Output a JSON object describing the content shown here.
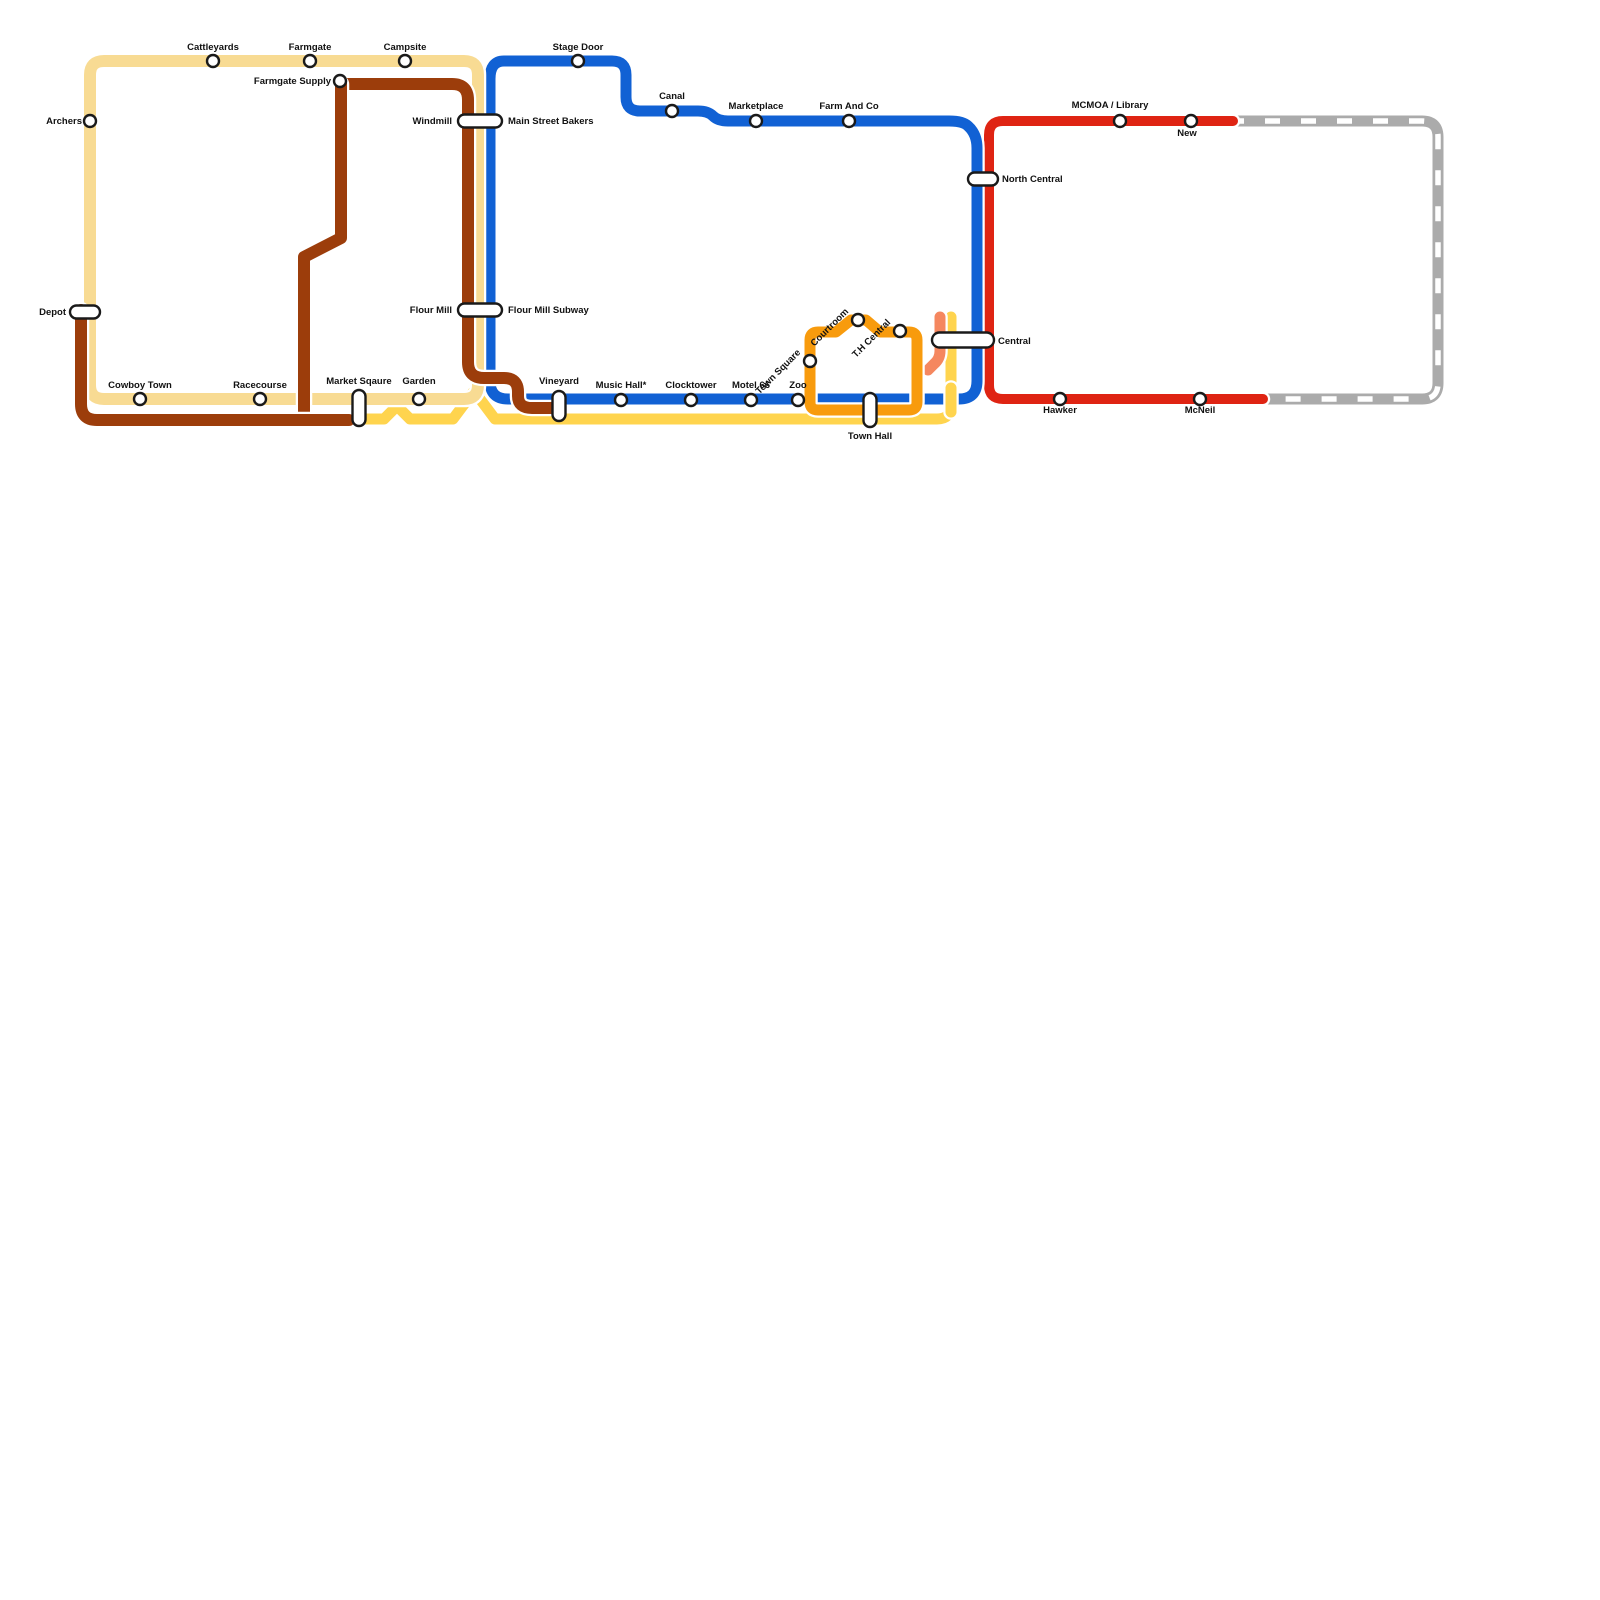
{
  "map": {
    "background": "#ffffff",
    "station_style": {
      "fill": "#ffffff",
      "stroke": "#1a1a1a",
      "stroke_width": 2.4,
      "circle_radius": 6,
      "label_size": 9.5
    },
    "lines": [
      {
        "id": "gray-planned",
        "color": "#ABABAB",
        "width": 11,
        "dash_overlay": {
          "color": "#ffffff",
          "width": 5.5,
          "dasharray": "15 21"
        },
        "d": "M 1237 121 H 1422 Q 1438 121 1438 137 V 383 Q 1438 399 1422 399 H 1264"
      },
      {
        "id": "red-line",
        "color": "#DF2413",
        "width": 10,
        "d": "M 1233 121 H 1003 Q 989 121 989 135 V 385 Q 989 399 1003 399 H 1263"
      },
      {
        "id": "yellow-line",
        "color": "#FFD44E",
        "width": 11,
        "d": "M 365 419 H 384 L 397 406 L 410 419 H 453 L 474 391 L 495 419 H 937 Q 951 419 951 405 V 317"
      },
      {
        "id": "salmon-line",
        "color": "#F5875F",
        "width": 11,
        "d": "M 940 317 V 351 Q 940 359 934 364 L 928 370"
      },
      {
        "id": "blue-line",
        "color": "#1161D4",
        "width": 11,
        "d": "M 504 61 H 612 Q 626 61 626 75 V 97 Q 626 111 640 111 H 698 Q 708 111 713 116 Q 718 121 728 121 H 949 Q 963 121 968 126 Q 977 134 977 148 V 381 Q 977 399 959 399 H 508 Q 490 399 490 381 V 79 Q 490 61 504 61 Z"
      },
      {
        "id": "cream-line",
        "color": "#F8DB93",
        "width": 12,
        "d": "M 104 61 H 464 Q 478 61 478 75 V 385 Q 478 399 464 399 H 104 Q 90 399 90 385 V 75 Q 90 61 104 61 Z"
      },
      {
        "id": "brown-line-north",
        "color": "#9C3D0B",
        "width": 12,
        "d": "M 341 84 H 452 Q 468 84 468 100 V 362 Q 468 378 484 378 H 504 Q 518 378 518 392 V 396 Q 518 408 532 408 H 552"
      },
      {
        "id": "brown-line-mid",
        "color": "#9C3D0B",
        "width": 12,
        "d": "M 341 84 V 238 L 304 257 V 414"
      },
      {
        "id": "brown-line-south",
        "color": "#9C3D0B",
        "width": 12,
        "d": "M 81 310 V 404 Q 81 420 97 420 H 349"
      },
      {
        "id": "orange-loop",
        "color": "#F89B0D",
        "width": 11,
        "d": "M 818 332 H 836 L 851 320 H 866 L 880 332 H 909 Q 917 332 917 340 V 402 Q 917 410 909 410 H 818 Q 810 410 810 402 V 340 Q 810 332 818 332 Z"
      },
      {
        "id": "yellow-line-overlay",
        "color": "#FFD44E",
        "width": 11,
        "d": "M 951 388 V 412"
      }
    ],
    "stations": [
      {
        "id": "archers",
        "label": "Archers",
        "shape": "circle",
        "x": 90,
        "y": 121,
        "lx": 82,
        "ly": 124,
        "anchor": "end"
      },
      {
        "id": "cattleyards",
        "label": "Cattleyards",
        "shape": "circle",
        "x": 213,
        "y": 61,
        "lx": 213,
        "ly": 50,
        "anchor": "middle"
      },
      {
        "id": "farmgate",
        "label": "Farmgate",
        "shape": "circle",
        "x": 310,
        "y": 61,
        "lx": 310,
        "ly": 50,
        "anchor": "middle"
      },
      {
        "id": "campsite",
        "label": "Campsite",
        "shape": "circle",
        "x": 405,
        "y": 61,
        "lx": 405,
        "ly": 50,
        "anchor": "middle"
      },
      {
        "id": "farmgate-supply",
        "label": "Farmgate Supply",
        "shape": "circle",
        "x": 340,
        "y": 81,
        "lx": 331,
        "ly": 84,
        "anchor": "end"
      },
      {
        "id": "stage-door",
        "label": "Stage Door",
        "shape": "circle",
        "x": 578,
        "y": 61,
        "lx": 578,
        "ly": 50,
        "anchor": "middle"
      },
      {
        "id": "canal",
        "label": "Canal",
        "shape": "circle",
        "x": 672,
        "y": 111,
        "lx": 672,
        "ly": 99,
        "anchor": "middle"
      },
      {
        "id": "marketplace",
        "label": "Marketplace",
        "shape": "circle",
        "x": 756,
        "y": 121,
        "lx": 756,
        "ly": 109,
        "anchor": "middle"
      },
      {
        "id": "farm-and-co",
        "label": "Farm And Co",
        "shape": "circle",
        "x": 849,
        "y": 121,
        "lx": 849,
        "ly": 109,
        "anchor": "middle"
      },
      {
        "id": "windmill",
        "label": "Windmill",
        "shape": "pill-h",
        "x": 480,
        "y": 121,
        "w": 44,
        "h": 13,
        "lx": 452,
        "ly": 124,
        "anchor": "end",
        "label2": "Main Street Bakers",
        "lx2": 508,
        "ly2": 124,
        "anchor2": "start"
      },
      {
        "id": "flour-mill",
        "label": "Flour Mill",
        "shape": "pill-h",
        "x": 480,
        "y": 310,
        "w": 44,
        "h": 13,
        "lx": 452,
        "ly": 313,
        "anchor": "end",
        "label2": "Flour Mill Subway",
        "lx2": 508,
        "ly2": 313,
        "anchor2": "start"
      },
      {
        "id": "depot",
        "label": "Depot",
        "shape": "pill-h",
        "x": 85,
        "y": 312,
        "w": 30,
        "h": 13,
        "lx": 66,
        "ly": 315,
        "anchor": "end"
      },
      {
        "id": "cowboy-town",
        "label": "Cowboy Town",
        "shape": "circle",
        "x": 140,
        "y": 399,
        "lx": 140,
        "ly": 388,
        "anchor": "middle"
      },
      {
        "id": "racecourse",
        "label": "Racecourse",
        "shape": "circle",
        "x": 260,
        "y": 399,
        "lx": 260,
        "ly": 388,
        "anchor": "middle"
      },
      {
        "id": "market-sqaure",
        "label": "Market Sqaure",
        "shape": "pill-v",
        "x": 359,
        "y": 408,
        "w": 13,
        "h": 36,
        "lx": 359,
        "ly": 384,
        "anchor": "middle"
      },
      {
        "id": "garden",
        "label": "Garden",
        "shape": "circle",
        "x": 419,
        "y": 399,
        "lx": 419,
        "ly": 384,
        "anchor": "middle"
      },
      {
        "id": "vineyard",
        "label": "Vineyard",
        "shape": "pill-v",
        "x": 559,
        "y": 406,
        "w": 13,
        "h": 30,
        "lx": 559,
        "ly": 384,
        "anchor": "middle"
      },
      {
        "id": "music-hall",
        "label": "Music Hall*",
        "shape": "circle",
        "x": 621,
        "y": 400,
        "lx": 621,
        "ly": 388,
        "anchor": "middle"
      },
      {
        "id": "clocktower",
        "label": "Clocktower",
        "shape": "circle",
        "x": 691,
        "y": 400,
        "lx": 691,
        "ly": 388,
        "anchor": "middle"
      },
      {
        "id": "motel-66",
        "label": "Motel 66",
        "shape": "circle",
        "x": 751,
        "y": 400,
        "lx": 751,
        "ly": 388,
        "anchor": "middle"
      },
      {
        "id": "zoo",
        "label": "Zoo",
        "shape": "circle",
        "x": 798,
        "y": 400,
        "lx": 798,
        "ly": 388,
        "anchor": "middle"
      },
      {
        "id": "town-square",
        "label": "Town Square",
        "shape": "circle",
        "x": 810,
        "y": 361,
        "lx": 801,
        "ly": 353,
        "anchor": "end",
        "rotate": -45
      },
      {
        "id": "courtroom",
        "label": "Courtroom",
        "shape": "circle",
        "x": 858,
        "y": 320,
        "lx": 849,
        "ly": 312,
        "anchor": "end",
        "rotate": -45
      },
      {
        "id": "th-central",
        "label": "T.H Central",
        "shape": "circle",
        "x": 900,
        "y": 331,
        "lx": 891,
        "ly": 323,
        "anchor": "end",
        "rotate": -45
      },
      {
        "id": "town-hall",
        "label": "Town Hall",
        "shape": "pill-v",
        "x": 870,
        "y": 410,
        "w": 13,
        "h": 34,
        "lx": 870,
        "ly": 439,
        "anchor": "middle"
      },
      {
        "id": "north-central",
        "label": "North Central",
        "shape": "pill-h",
        "x": 983,
        "y": 179,
        "w": 30,
        "h": 13,
        "lx": 1002,
        "ly": 182,
        "anchor": "start"
      },
      {
        "id": "central",
        "label": "Central",
        "shape": "pill-h",
        "x": 963,
        "y": 340,
        "w": 62,
        "h": 15,
        "lx": 998,
        "ly": 344,
        "anchor": "start"
      },
      {
        "id": "mcmoa-library",
        "label": "MCMOA / Library",
        "shape": "circle",
        "x": 1120,
        "y": 121,
        "lx": 1110,
        "ly": 108,
        "anchor": "middle"
      },
      {
        "id": "new",
        "label": "New",
        "shape": "circle",
        "x": 1191,
        "y": 121,
        "lx": 1187,
        "ly": 136,
        "anchor": "middle"
      },
      {
        "id": "hawker",
        "label": "Hawker",
        "shape": "circle",
        "x": 1060,
        "y": 399,
        "lx": 1060,
        "ly": 413,
        "anchor": "middle"
      },
      {
        "id": "mcneil",
        "label": "McNeil",
        "shape": "circle",
        "x": 1200,
        "y": 399,
        "lx": 1200,
        "ly": 413,
        "anchor": "middle"
      }
    ]
  }
}
